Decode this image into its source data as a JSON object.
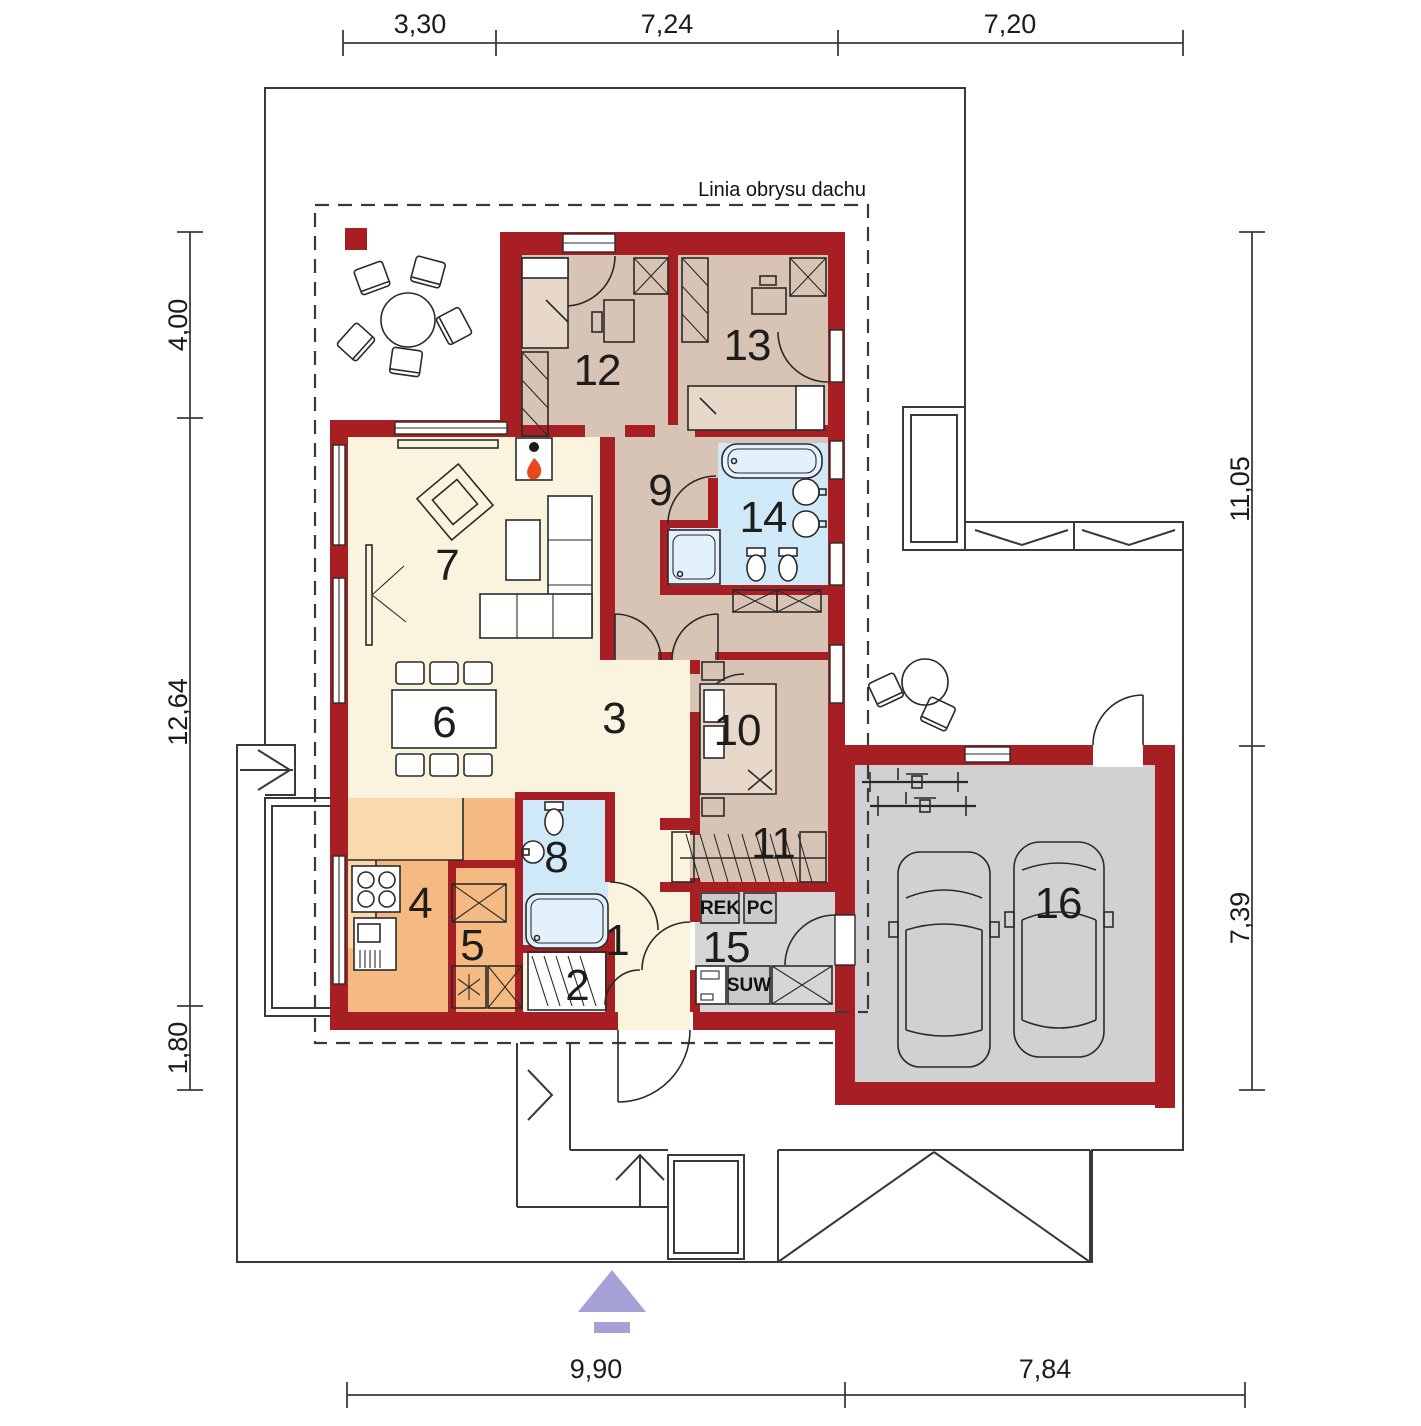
{
  "roof_outline_label": "Linia obrysu dachu",
  "dimensions": {
    "top": [
      "3,30",
      "7,24",
      "7,20"
    ],
    "left": [
      "4,00",
      "12,64",
      "1,80"
    ],
    "right": [
      "11,05",
      "7,39"
    ],
    "bottom": [
      "9,90",
      "7,84"
    ]
  },
  "rooms": [
    "1",
    "2",
    "3",
    "4",
    "5",
    "6",
    "7",
    "8",
    "9",
    "10",
    "11",
    "12",
    "13",
    "14",
    "15",
    "16"
  ],
  "equipment": {
    "rek": "REK",
    "pc": "PC",
    "suw": "SUW"
  },
  "colors": {
    "wall": "#a81f23",
    "cream": "#faf4df",
    "beige": "#d8c4b5",
    "blue": "#cfe9f8",
    "orange": "#f5ba81",
    "orangeLight": "#fbd9af",
    "gray": "#d6d6d6",
    "garageGray": "#d0d1d3",
    "equipGray": "#c9cacb",
    "flame": "#e8481e",
    "purple": "#a5a0d6",
    "line": "#2b2a29",
    "boundary": "#3b3938"
  }
}
